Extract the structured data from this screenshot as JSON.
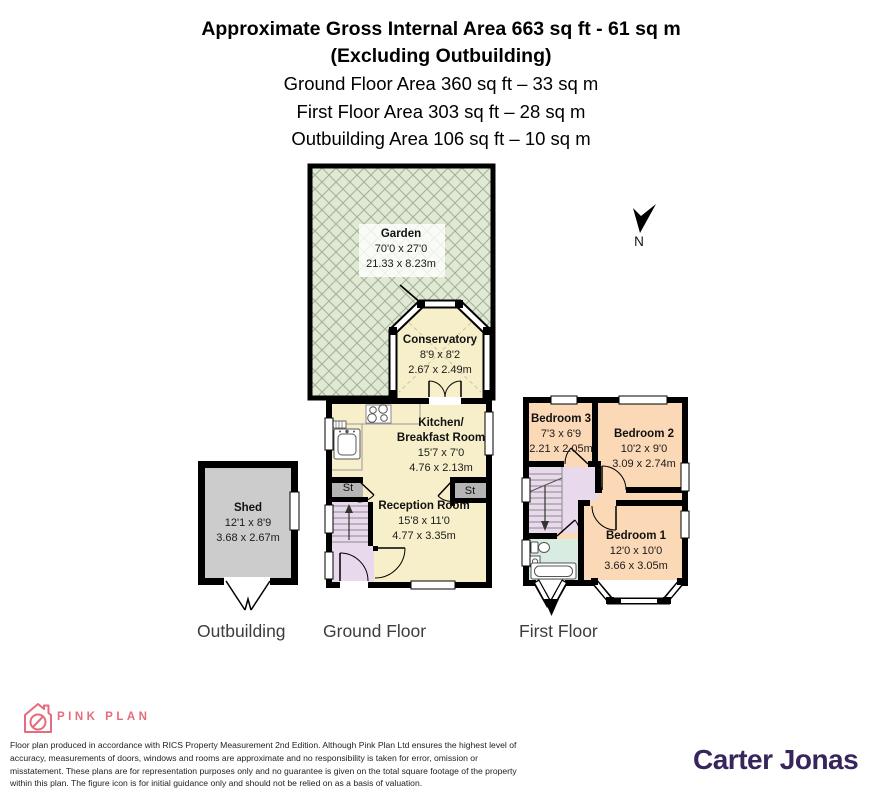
{
  "header": {
    "title_line1": "Approximate Gross Internal Area 663 sq ft - 61 sq m",
    "title_line2": "(Excluding Outbuilding)",
    "area_lines": [
      "Ground Floor Area 360 sq ft – 33 sq m",
      "First Floor Area 303 sq ft – 28 sq m",
      "Outbuilding Area 106 sq ft – 10 sq m"
    ]
  },
  "rooms": {
    "garden": {
      "name": "Garden",
      "dims_ft": "70'0 x 27'0",
      "dims_m": "21.33 x 8.23m"
    },
    "conservatory": {
      "name": "Conservatory",
      "dims_ft": "8'9 x 8'2",
      "dims_m": "2.67 x 2.49m"
    },
    "kitchen": {
      "name_line1": "Kitchen/",
      "name_line2": "Breakfast Room",
      "dims_ft": "15'7 x 7'0",
      "dims_m": "4.76 x 2.13m"
    },
    "reception": {
      "name": "Reception Room",
      "dims_ft": "15'8 x 11'0",
      "dims_m": "4.77 x 3.35m"
    },
    "shed": {
      "name": "Shed",
      "dims_ft": "12'1 x 8'9",
      "dims_m": "3.68 x 2.67m"
    },
    "bedroom1": {
      "name": "Bedroom 1",
      "dims_ft": "12'0 x 10'0",
      "dims_m": "3.66 x 3.05m"
    },
    "bedroom2": {
      "name": "Bedroom 2",
      "dims_ft": "10'2 x 9'0",
      "dims_m": "3.09 x 2.74m"
    },
    "bedroom3": {
      "name": "Bedroom 3",
      "dims_ft": "7'3 x 6'9",
      "dims_m": "2.21 x 2.05m"
    },
    "storage_left": "St",
    "storage_right": "St"
  },
  "floor_labels": {
    "outbuilding": "Outbuilding",
    "ground": "Ground Floor",
    "first": "First Floor"
  },
  "compass": {
    "north_label": "N"
  },
  "footer": {
    "brand_name": "PINK PLAN",
    "disclaimer": "Floor plan produced in accordance with RICS Property Measurement 2nd Edition. Although Pink Plan Ltd ensures the highest level of accuracy, measurements of doors, windows and rooms are approximate and no responsibility is taken for error, omission or misstatement. These plans are for representation purposes only and no guarantee is given on the total square footage of the property within this plan. The figure icon is for initial guidance only and should not be relied on as a basis of valuation.",
    "agency_name": "Carter Jonas"
  },
  "colors": {
    "room_cream": "#f6efc9",
    "bedroom_peach": "#fbd8b6",
    "hall_lavender": "#e9d9ec",
    "bathroom_mint": "#d8ece1",
    "shed_grey": "#cccccc",
    "storage_grey": "#b5b5b5",
    "garden_green": "#dfe9d4",
    "garden_lattice": "#a7b199",
    "wall_black": "#000000",
    "brand_pink": "#e66b7d",
    "agency_purple": "#38255c"
  }
}
